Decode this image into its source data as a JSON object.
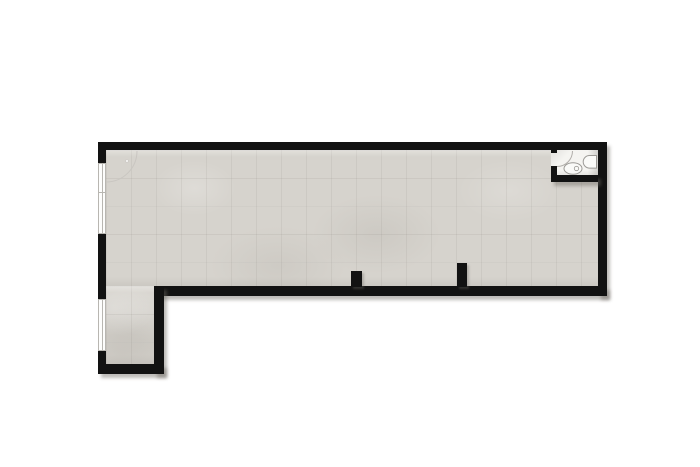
{
  "title": "empty-l-shaped-floor-plan-with-bathroom",
  "canvas": {
    "width": 700,
    "height": 467
  },
  "colors": {
    "background": "#ffffff",
    "wall": "#121212",
    "floor": "#d6d3cd",
    "bath_floor": "#f5f4f1",
    "window_fill": "#fdfdfc",
    "window_line": "#b8b6b1",
    "shadow": "rgba(110,106,100,0.45)",
    "fixture_stroke": "#9c9a96",
    "fixture_fill": "#fafaf8"
  },
  "plan": {
    "floors": [
      {
        "name": "main-room-floor",
        "kind": "tile",
        "x": 106,
        "y": 150,
        "w": 492,
        "h": 136
      },
      {
        "name": "leg-room-floor",
        "kind": "tile",
        "x": 106,
        "y": 286,
        "w": 48,
        "h": 78
      },
      {
        "name": "bathroom-floor",
        "kind": "bath",
        "x": 551,
        "y": 150,
        "w": 47,
        "h": 25
      }
    ],
    "walls": [
      {
        "name": "top-wall",
        "x": 98,
        "y": 142,
        "w": 509,
        "h": 8,
        "shadow": false
      },
      {
        "name": "right-wall",
        "x": 598,
        "y": 142,
        "w": 9,
        "h": 154,
        "shadow": true
      },
      {
        "name": "bottom-wall-main",
        "x": 154,
        "y": 286,
        "w": 453,
        "h": 10,
        "shadow": true
      },
      {
        "name": "left-wall-upper",
        "x": 98,
        "y": 142,
        "w": 8,
        "h": 21,
        "shadow": false
      },
      {
        "name": "left-wall-middle",
        "x": 98,
        "y": 234,
        "w": 8,
        "h": 65,
        "shadow": false
      },
      {
        "name": "left-wall-lower",
        "x": 98,
        "y": 351,
        "w": 8,
        "h": 23,
        "shadow": false
      },
      {
        "name": "leg-right-wall",
        "x": 154,
        "y": 286,
        "w": 10,
        "h": 88,
        "shadow": true
      },
      {
        "name": "leg-bottom-wall",
        "x": 98,
        "y": 364,
        "w": 66,
        "h": 10,
        "shadow": true
      },
      {
        "name": "partition-stub-1",
        "x": 351,
        "y": 271,
        "w": 11,
        "h": 16,
        "shadow": false,
        "small_shadow": true
      },
      {
        "name": "partition-stub-2",
        "x": 457,
        "y": 263,
        "w": 10,
        "h": 24,
        "shadow": false,
        "small_shadow": true
      },
      {
        "name": "bathroom-left-wall-nub",
        "x": 551,
        "y": 150,
        "w": 6,
        "h": 3,
        "shadow": false
      },
      {
        "name": "bathroom-left-wall",
        "x": 551,
        "y": 166,
        "w": 6,
        "h": 16,
        "shadow": false
      },
      {
        "name": "bathroom-bottom-wall",
        "x": 551,
        "y": 175,
        "w": 47,
        "h": 7,
        "shadow": true
      }
    ],
    "windows": [
      {
        "name": "window-left-upper",
        "x": 98,
        "y": 163,
        "w": 8,
        "h": 71,
        "dividers": [
          "v",
          "h"
        ]
      },
      {
        "name": "window-left-lower",
        "x": 98,
        "y": 299,
        "w": 8,
        "h": 52,
        "dividers": [
          "v"
        ]
      }
    ],
    "door_arcs": [
      {
        "name": "entry-door-swing",
        "path": "M 137 151 A 31 31 0 0 1 106 182",
        "color": "#c9c6c1",
        "dot": {
          "cx": 127,
          "cy": 161,
          "r": 1.5
        }
      },
      {
        "name": "bathroom-door-swing",
        "path": "M 572.5 151 A 15.5 15.5 0 0 1 557 166.5",
        "color": "#b1aeaa"
      }
    ],
    "fixtures": {
      "toilet": {
        "cx": 573,
        "cy": 168.5,
        "rx": 9,
        "ry": 5.8,
        "button_cx": 576.5,
        "button_cy": 168.5,
        "button_r": 2.2
      },
      "sink": {
        "path": "M 596.5 155.5 L 589.5 155.5 A 6.3 6.3 0 0 0 589.5 168.1 L 596.5 168.1 Z"
      }
    }
  }
}
